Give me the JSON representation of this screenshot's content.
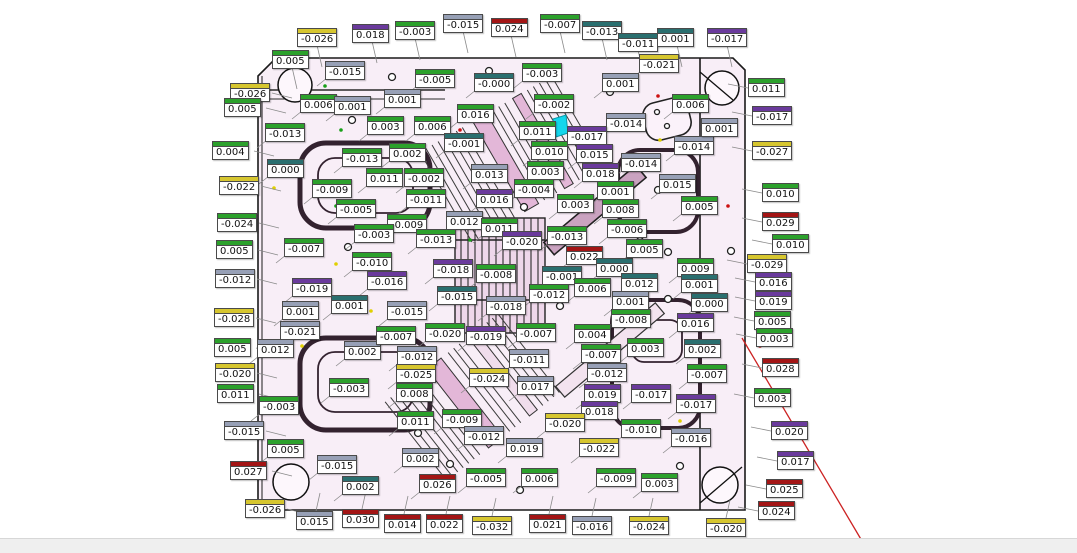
{
  "app": {
    "view": "mold-plate-deviation-inspection",
    "background_color": "#ffffff",
    "plate_fill_color": "#f8eef7",
    "statusbar_color": "#efefef",
    "highlight_color": "#14d6ec",
    "redline_color": "#cc2222"
  },
  "label_colors": {
    "green": "#2ca12c",
    "red": "#a31515",
    "yellow": "#d6c62f",
    "purple": "#6a3a9c",
    "gray": "#97a0b6",
    "teal": "#2a6f6f"
  },
  "labels": [
    {
      "v": "-0.026",
      "x": 297,
      "y": 28,
      "c": "yellow"
    },
    {
      "v": "0.018",
      "x": 352,
      "y": 24,
      "c": "purple"
    },
    {
      "v": "-0.003",
      "x": 395,
      "y": 21,
      "c": "green"
    },
    {
      "v": "-0.015",
      "x": 443,
      "y": 14,
      "c": "gray"
    },
    {
      "v": "0.024",
      "x": 491,
      "y": 18,
      "c": "red"
    },
    {
      "v": "-0.007",
      "x": 540,
      "y": 14,
      "c": "green"
    },
    {
      "v": "-0.013",
      "x": 582,
      "y": 21,
      "c": "teal"
    },
    {
      "v": "-0.011",
      "x": 618,
      "y": 33,
      "c": "teal"
    },
    {
      "v": "0.001",
      "x": 657,
      "y": 28,
      "c": "teal"
    },
    {
      "v": "-0.017",
      "x": 707,
      "y": 28,
      "c": "purple"
    },
    {
      "v": "0.005",
      "x": 272,
      "y": 50,
      "c": "green"
    },
    {
      "v": "-0.015",
      "x": 325,
      "y": 61,
      "c": "gray"
    },
    {
      "v": "-0.005",
      "x": 415,
      "y": 69,
      "c": "green"
    },
    {
      "v": "-0.000",
      "x": 474,
      "y": 73,
      "c": "teal"
    },
    {
      "v": "-0.003",
      "x": 522,
      "y": 63,
      "c": "green"
    },
    {
      "v": "0.001",
      "x": 602,
      "y": 73,
      "c": "gray"
    },
    {
      "v": "-0.021",
      "x": 639,
      "y": 54,
      "c": "yellow"
    },
    {
      "v": "0.011",
      "x": 748,
      "y": 78,
      "c": "green"
    },
    {
      "v": "-0.026",
      "x": 230,
      "y": 83,
      "c": "yellow"
    },
    {
      "v": "0.005",
      "x": 224,
      "y": 98,
      "c": "green"
    },
    {
      "v": "0.004",
      "x": 212,
      "y": 141,
      "c": "green"
    },
    {
      "v": "-0.022",
      "x": 219,
      "y": 176,
      "c": "yellow"
    },
    {
      "v": "-0.024",
      "x": 217,
      "y": 213,
      "c": "green"
    },
    {
      "v": "0.005",
      "x": 216,
      "y": 240,
      "c": "green"
    },
    {
      "v": "-0.012",
      "x": 215,
      "y": 269,
      "c": "gray"
    },
    {
      "v": "-0.028",
      "x": 214,
      "y": 308,
      "c": "yellow"
    },
    {
      "v": "0.005",
      "x": 214,
      "y": 338,
      "c": "green"
    },
    {
      "v": "-0.020",
      "x": 215,
      "y": 363,
      "c": "yellow"
    },
    {
      "v": "0.011",
      "x": 217,
      "y": 384,
      "c": "green"
    },
    {
      "v": "-0.015",
      "x": 224,
      "y": 421,
      "c": "gray"
    },
    {
      "v": "0.027",
      "x": 230,
      "y": 461,
      "c": "red"
    },
    {
      "v": "-0.026",
      "x": 245,
      "y": 499,
      "c": "yellow"
    },
    {
      "v": "0.006",
      "x": 300,
      "y": 94,
      "c": "green"
    },
    {
      "v": "0.001",
      "x": 334,
      "y": 96,
      "c": "gray"
    },
    {
      "v": "-0.013",
      "x": 265,
      "y": 123,
      "c": "green"
    },
    {
      "v": "0.000",
      "x": 267,
      "y": 159,
      "c": "teal"
    },
    {
      "v": "-0.009",
      "x": 312,
      "y": 179,
      "c": "green"
    },
    {
      "v": "-0.005",
      "x": 336,
      "y": 199,
      "c": "green"
    },
    {
      "v": "-0.007",
      "x": 284,
      "y": 238,
      "c": "green"
    },
    {
      "v": "-0.019",
      "x": 292,
      "y": 278,
      "c": "purple"
    },
    {
      "v": "0.001",
      "x": 282,
      "y": 301,
      "c": "gray"
    },
    {
      "v": "-0.021",
      "x": 280,
      "y": 321,
      "c": "gray"
    },
    {
      "v": "0.012",
      "x": 257,
      "y": 339,
      "c": "gray"
    },
    {
      "v": "0.001",
      "x": 331,
      "y": 295,
      "c": "teal"
    },
    {
      "v": "-0.003",
      "x": 259,
      "y": 396,
      "c": "green"
    },
    {
      "v": "0.002",
      "x": 344,
      "y": 341,
      "c": "gray"
    },
    {
      "v": "-0.015",
      "x": 317,
      "y": 455,
      "c": "gray"
    },
    {
      "v": "0.005",
      "x": 267,
      "y": 439,
      "c": "green"
    },
    {
      "v": "0.002",
      "x": 342,
      "y": 476,
      "c": "teal"
    },
    {
      "v": "0.015",
      "x": 296,
      "y": 511,
      "c": "gray"
    },
    {
      "v": "0.030",
      "x": 342,
      "y": 509,
      "c": "red"
    },
    {
      "v": "0.001",
      "x": 384,
      "y": 89,
      "c": "gray"
    },
    {
      "v": "0.003",
      "x": 367,
      "y": 116,
      "c": "green"
    },
    {
      "v": "0.006",
      "x": 414,
      "y": 116,
      "c": "green"
    },
    {
      "v": "0.016",
      "x": 457,
      "y": 104,
      "c": "green"
    },
    {
      "v": "-0.002",
      "x": 534,
      "y": 94,
      "c": "green"
    },
    {
      "v": "0.011",
      "x": 519,
      "y": 121,
      "c": "green"
    },
    {
      "v": "-0.001",
      "x": 444,
      "y": 133,
      "c": "teal"
    },
    {
      "v": "0.010",
      "x": 531,
      "y": 141,
      "c": "green"
    },
    {
      "v": "-0.013",
      "x": 342,
      "y": 148,
      "c": "green"
    },
    {
      "v": "0.002",
      "x": 389,
      "y": 143,
      "c": "green"
    },
    {
      "v": "0.003",
      "x": 527,
      "y": 161,
      "c": "green"
    },
    {
      "v": "0.011",
      "x": 366,
      "y": 168,
      "c": "green"
    },
    {
      "v": "-0.002",
      "x": 404,
      "y": 168,
      "c": "green"
    },
    {
      "v": "0.013",
      "x": 471,
      "y": 164,
      "c": "gray"
    },
    {
      "v": "-0.004",
      "x": 514,
      "y": 179,
      "c": "green"
    },
    {
      "v": "-0.011",
      "x": 406,
      "y": 189,
      "c": "green"
    },
    {
      "v": "0.016",
      "x": 476,
      "y": 189,
      "c": "purple"
    },
    {
      "v": "-0.014",
      "x": 606,
      "y": 113,
      "c": "gray"
    },
    {
      "v": "-0.017",
      "x": 567,
      "y": 126,
      "c": "purple"
    },
    {
      "v": "0.015",
      "x": 576,
      "y": 144,
      "c": "purple"
    },
    {
      "v": "-0.014",
      "x": 621,
      "y": 153,
      "c": "gray"
    },
    {
      "v": "0.018",
      "x": 582,
      "y": 163,
      "c": "purple"
    },
    {
      "v": "0.001",
      "x": 597,
      "y": 181,
      "c": "green"
    },
    {
      "v": "0.015",
      "x": 659,
      "y": 174,
      "c": "gray"
    },
    {
      "v": "0.003",
      "x": 557,
      "y": 194,
      "c": "green"
    },
    {
      "v": "0.008",
      "x": 602,
      "y": 199,
      "c": "green"
    },
    {
      "v": "0.005",
      "x": 681,
      "y": 196,
      "c": "green"
    },
    {
      "v": "-0.014",
      "x": 674,
      "y": 136,
      "c": "gray"
    },
    {
      "v": "0.001",
      "x": 701,
      "y": 118,
      "c": "gray"
    },
    {
      "v": "0.006",
      "x": 672,
      "y": 94,
      "c": "green"
    },
    {
      "v": "-0.006",
      "x": 607,
      "y": 219,
      "c": "green"
    },
    {
      "v": "-0.009",
      "x": 387,
      "y": 214,
      "c": "green"
    },
    {
      "v": "0.012",
      "x": 446,
      "y": 211,
      "c": "gray"
    },
    {
      "v": "0.011",
      "x": 481,
      "y": 218,
      "c": "green"
    },
    {
      "v": "-0.003",
      "x": 354,
      "y": 224,
      "c": "green"
    },
    {
      "v": "-0.013",
      "x": 416,
      "y": 229,
      "c": "green"
    },
    {
      "v": "-0.020",
      "x": 502,
      "y": 231,
      "c": "purple"
    },
    {
      "v": "-0.013",
      "x": 547,
      "y": 226,
      "c": "green"
    },
    {
      "v": "0.022",
      "x": 566,
      "y": 246,
      "c": "red"
    },
    {
      "v": "-0.010",
      "x": 352,
      "y": 252,
      "c": "green"
    },
    {
      "v": "-0.018",
      "x": 433,
      "y": 259,
      "c": "purple"
    },
    {
      "v": "-0.008",
      "x": 476,
      "y": 264,
      "c": "green"
    },
    {
      "v": "-0.001",
      "x": 542,
      "y": 266,
      "c": "teal"
    },
    {
      "v": "0.000",
      "x": 596,
      "y": 258,
      "c": "teal"
    },
    {
      "v": "-0.016",
      "x": 367,
      "y": 271,
      "c": "purple"
    },
    {
      "v": "-0.015",
      "x": 437,
      "y": 286,
      "c": "teal"
    },
    {
      "v": "-0.012",
      "x": 529,
      "y": 284,
      "c": "green"
    },
    {
      "v": "-0.018",
      "x": 486,
      "y": 296,
      "c": "gray"
    },
    {
      "v": "-0.015",
      "x": 387,
      "y": 301,
      "c": "gray"
    },
    {
      "v": "0.006",
      "x": 574,
      "y": 278,
      "c": "green"
    },
    {
      "v": "0.005",
      "x": 626,
      "y": 239,
      "c": "green"
    },
    {
      "v": "0.009",
      "x": 677,
      "y": 258,
      "c": "green"
    },
    {
      "v": "0.012",
      "x": 621,
      "y": 273,
      "c": "teal"
    },
    {
      "v": "0.001",
      "x": 681,
      "y": 274,
      "c": "teal"
    },
    {
      "v": "0.001",
      "x": 612,
      "y": 291,
      "c": "gray"
    },
    {
      "v": "0.000",
      "x": 691,
      "y": 293,
      "c": "teal"
    },
    {
      "v": "-0.008",
      "x": 611,
      "y": 309,
      "c": "green"
    },
    {
      "v": "0.016",
      "x": 677,
      "y": 313,
      "c": "purple"
    },
    {
      "v": "-0.017",
      "x": 752,
      "y": 106,
      "c": "purple"
    },
    {
      "v": "-0.027",
      "x": 752,
      "y": 141,
      "c": "yellow"
    },
    {
      "v": "0.010",
      "x": 762,
      "y": 183,
      "c": "green"
    },
    {
      "v": "0.029",
      "x": 762,
      "y": 212,
      "c": "red"
    },
    {
      "v": "0.010",
      "x": 772,
      "y": 234,
      "c": "green"
    },
    {
      "v": "-0.029",
      "x": 747,
      "y": 254,
      "c": "yellow"
    },
    {
      "v": "0.016",
      "x": 755,
      "y": 272,
      "c": "purple"
    },
    {
      "v": "0.019",
      "x": 755,
      "y": 291,
      "c": "purple"
    },
    {
      "v": "0.005",
      "x": 754,
      "y": 311,
      "c": "green"
    },
    {
      "v": "0.003",
      "x": 756,
      "y": 328,
      "c": "green"
    },
    {
      "v": "0.028",
      "x": 762,
      "y": 358,
      "c": "red"
    },
    {
      "v": "0.003",
      "x": 754,
      "y": 388,
      "c": "green"
    },
    {
      "v": "0.020",
      "x": 771,
      "y": 421,
      "c": "purple"
    },
    {
      "v": "0.017",
      "x": 777,
      "y": 451,
      "c": "purple"
    },
    {
      "v": "0.025",
      "x": 766,
      "y": 479,
      "c": "red"
    },
    {
      "v": "0.024",
      "x": 758,
      "y": 501,
      "c": "red"
    },
    {
      "v": "-0.007",
      "x": 376,
      "y": 326,
      "c": "green"
    },
    {
      "v": "-0.020",
      "x": 425,
      "y": 323,
      "c": "green"
    },
    {
      "v": "-0.019",
      "x": 466,
      "y": 326,
      "c": "purple"
    },
    {
      "v": "-0.007",
      "x": 516,
      "y": 323,
      "c": "green"
    },
    {
      "v": "0.004",
      "x": 574,
      "y": 324,
      "c": "green"
    },
    {
      "v": "0.003",
      "x": 627,
      "y": 338,
      "c": "green"
    },
    {
      "v": "0.002",
      "x": 684,
      "y": 339,
      "c": "teal"
    },
    {
      "v": "-0.012",
      "x": 397,
      "y": 346,
      "c": "gray"
    },
    {
      "v": "-0.011",
      "x": 509,
      "y": 349,
      "c": "gray"
    },
    {
      "v": "-0.007",
      "x": 581,
      "y": 344,
      "c": "green"
    },
    {
      "v": "-0.025",
      "x": 396,
      "y": 364,
      "c": "yellow"
    },
    {
      "v": "-0.024",
      "x": 469,
      "y": 368,
      "c": "yellow"
    },
    {
      "v": "0.017",
      "x": 517,
      "y": 376,
      "c": "gray"
    },
    {
      "v": "-0.012",
      "x": 587,
      "y": 363,
      "c": "gray"
    },
    {
      "v": "-0.007",
      "x": 687,
      "y": 364,
      "c": "green"
    },
    {
      "v": "0.008",
      "x": 396,
      "y": 383,
      "c": "green"
    },
    {
      "v": "-0.003",
      "x": 329,
      "y": 378,
      "c": "green"
    },
    {
      "v": "0.019",
      "x": 584,
      "y": 384,
      "c": "purple"
    },
    {
      "v": "-0.017",
      "x": 631,
      "y": 384,
      "c": "purple"
    },
    {
      "v": "-0.017",
      "x": 676,
      "y": 394,
      "c": "purple"
    },
    {
      "v": "0.018",
      "x": 581,
      "y": 401,
      "c": "purple"
    },
    {
      "v": "0.011",
      "x": 397,
      "y": 411,
      "c": "green"
    },
    {
      "v": "-0.009",
      "x": 442,
      "y": 409,
      "c": "green"
    },
    {
      "v": "-0.020",
      "x": 545,
      "y": 413,
      "c": "yellow"
    },
    {
      "v": "-0.010",
      "x": 621,
      "y": 419,
      "c": "green"
    },
    {
      "v": "-0.012",
      "x": 464,
      "y": 426,
      "c": "gray"
    },
    {
      "v": "-0.016",
      "x": 671,
      "y": 428,
      "c": "gray"
    },
    {
      "v": "0.019",
      "x": 506,
      "y": 438,
      "c": "gray"
    },
    {
      "v": "-0.022",
      "x": 579,
      "y": 438,
      "c": "yellow"
    },
    {
      "v": "0.002",
      "x": 402,
      "y": 448,
      "c": "gray"
    },
    {
      "v": "-0.005",
      "x": 466,
      "y": 468,
      "c": "green"
    },
    {
      "v": "0.006",
      "x": 521,
      "y": 468,
      "c": "green"
    },
    {
      "v": "0.026",
      "x": 419,
      "y": 474,
      "c": "red"
    },
    {
      "v": "-0.009",
      "x": 596,
      "y": 468,
      "c": "green"
    },
    {
      "v": "0.003",
      "x": 641,
      "y": 473,
      "c": "green"
    },
    {
      "v": "0.014",
      "x": 384,
      "y": 514,
      "c": "red"
    },
    {
      "v": "0.022",
      "x": 426,
      "y": 514,
      "c": "red"
    },
    {
      "v": "-0.032",
      "x": 472,
      "y": 516,
      "c": "yellow"
    },
    {
      "v": "0.021",
      "x": 529,
      "y": 514,
      "c": "red"
    },
    {
      "v": "-0.016",
      "x": 572,
      "y": 516,
      "c": "gray"
    },
    {
      "v": "-0.024",
      "x": 629,
      "y": 516,
      "c": "yellow"
    },
    {
      "v": "-0.020",
      "x": 706,
      "y": 518,
      "c": "yellow"
    }
  ]
}
